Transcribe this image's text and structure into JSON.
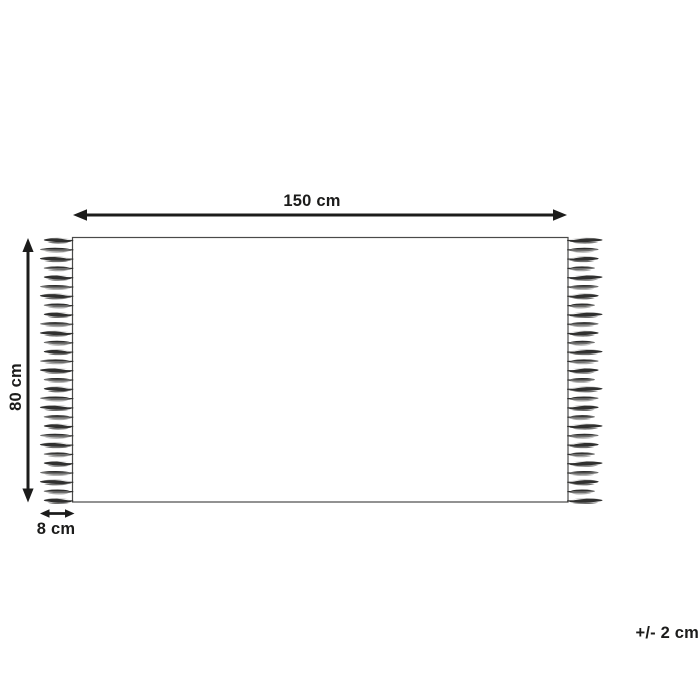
{
  "diagram": {
    "type": "rug-dimension-diagram",
    "labels": {
      "width": "150 cm",
      "height": "80 cm",
      "fringe": "8 cm",
      "tolerance": "+/- 2 cm"
    },
    "dimensions": {
      "width_cm": 150,
      "height_cm": 80,
      "fringe_cm": 8,
      "tolerance_cm": 2
    },
    "colors": {
      "ink": "#1c1c1b",
      "outline": "#4a4a49",
      "tassel_dark": "#30302f",
      "tassel_mid": "#6e6e6d",
      "tassel_light": "#ababaa",
      "background": "#ffffff"
    }
  }
}
